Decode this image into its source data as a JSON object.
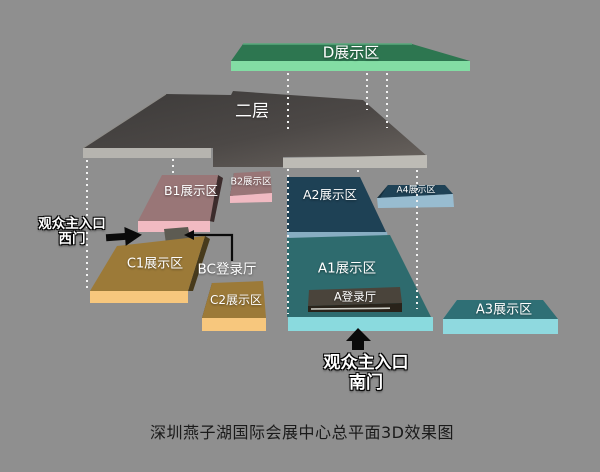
{
  "caption": "深圳燕子湖国际会展中心总平面3D效果图",
  "zones": {
    "d": {
      "label": "D展示区",
      "top_color": "#2d7650",
      "front_color": "#83dda4"
    },
    "second_floor": {
      "label": "二层",
      "top_color": "#454240",
      "front_left_color": "#b6b4af",
      "front_right_color": "#bdbbb5"
    },
    "b1": {
      "label": "B1展示区",
      "top_color": "#997677",
      "front_color": "#f1bac2"
    },
    "b2": {
      "label": "B2展示区",
      "top_color": "#997677",
      "front_color": "#f1bac2"
    },
    "c1": {
      "label": "C1展示区",
      "top_color": "#9c7a38",
      "front_color": "#f7c77d"
    },
    "c2": {
      "label": "C2展示区",
      "top_color": "#9c7a38",
      "front_color": "#f7c77d"
    },
    "a1": {
      "label": "A1展示区",
      "top_color": "#2e6b6e",
      "front_color": "#8adade"
    },
    "a2": {
      "label": "A2展示区",
      "top_color": "#1e4155",
      "front_color": "#88adc2"
    },
    "a3": {
      "label": "A3展示区",
      "top_color": "#2f6f75",
      "front_color": "#8fd9df"
    },
    "a4": {
      "label": "A4展示区",
      "top_color": "#1f4256",
      "front_color": "#98bcd0"
    },
    "bc_hall": {
      "label": "BC登录厅",
      "top_color": "#5d5b52"
    },
    "a_hall": {
      "label": "A登录厅",
      "top_color": "#4a443b",
      "front_color": "#29231a"
    }
  },
  "entrances": {
    "west": {
      "line1": "观众主入口",
      "line2": "西门"
    },
    "south": {
      "line1": "观众主入口",
      "line2": "南门"
    }
  }
}
